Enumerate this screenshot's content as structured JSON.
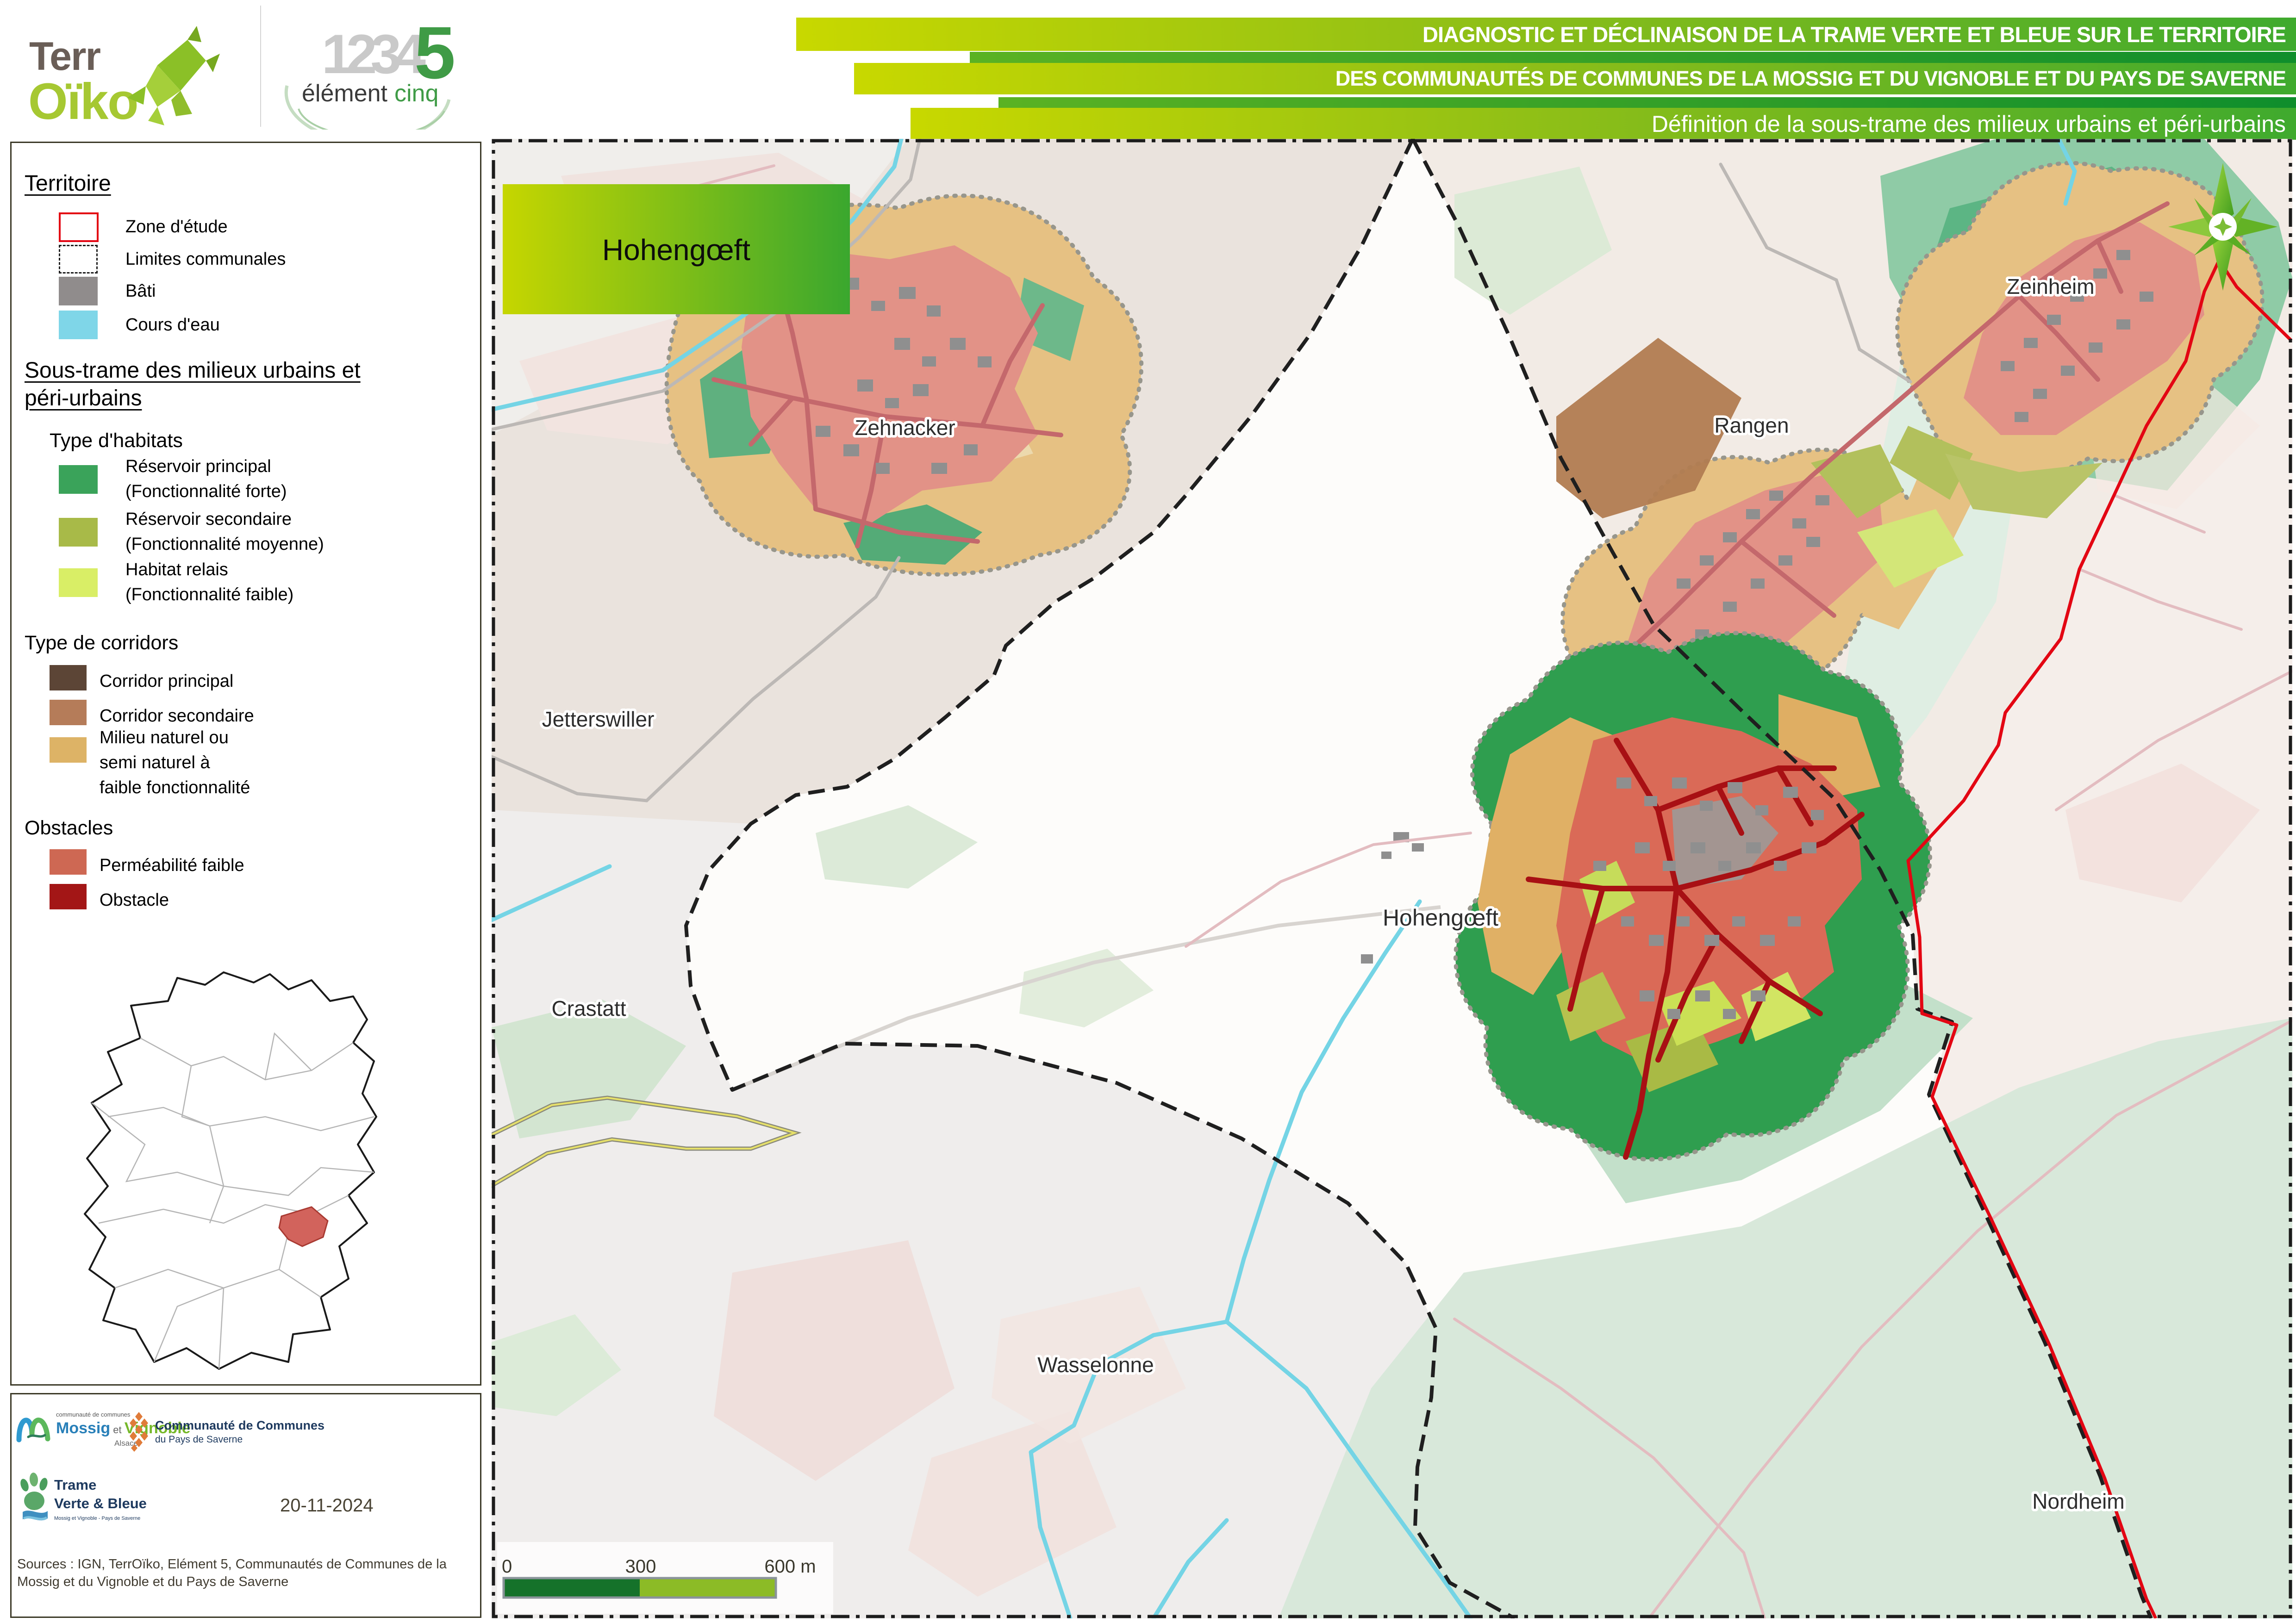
{
  "header": {
    "terroiko": {
      "line1": "Terr",
      "line2": "Oïko"
    },
    "element5": {
      "numbers": "1234",
      "five": "5",
      "word1": "élément",
      "word2": "cinq"
    },
    "banners": [
      {
        "text": "DIAGNOSTIC ET DÉCLINAISON DE LA TRAME VERTE ET BLEUE SUR LE TERRITOIRE"
      },
      {
        "text": "DES COMMUNAUTÉS DE COMMUNES DE LA MOSSIG ET DU VIGNOBLE ET DU PAYS DE SAVERNE"
      },
      {
        "text": "Définition de la sous-trame des milieux urbains et péri-urbains"
      }
    ]
  },
  "legend": {
    "territoire": {
      "title": "Territoire",
      "items": [
        {
          "label": "Zone d'étude",
          "color": "#e30613"
        },
        {
          "label": "Limites communales",
          "color": "#1f1f1f"
        },
        {
          "label": "Bâti",
          "color": "#908c8c"
        },
        {
          "label": "Cours d'eau",
          "color": "#7fd6e8"
        }
      ]
    },
    "soustrame": {
      "title_line1": "Sous-trame des milieux urbains et",
      "title_line2": "péri-urbains",
      "habitats": {
        "title": "Type d'habitats",
        "items": [
          {
            "line1": "Réservoir principal",
            "line2": "(Fonctionnalité forte)",
            "color": "#3aa35a"
          },
          {
            "line1": "Réservoir secondaire",
            "line2": "(Fonctionnalité moyenne)",
            "color": "#a8ba48"
          },
          {
            "line1": "Habitat relais",
            "line2": "(Fonctionnalité faible)",
            "color": "#d9ee66"
          }
        ]
      },
      "corridors": {
        "title": "Type de corridors",
        "items": [
          {
            "label": "Corridor principal",
            "color": "#5c4536"
          },
          {
            "label": "Corridor secondaire",
            "color": "#b57c59"
          },
          {
            "line1": "Milieu naturel ou",
            "line2": "semi naturel à",
            "line3": "faible fonctionnalité",
            "color": "#ddb366"
          }
        ]
      },
      "obstacles": {
        "title": "Obstacles",
        "items": [
          {
            "label": "Perméabilité faible",
            "color": "#ce6853"
          },
          {
            "label": "Obstacle",
            "color": "#a31616"
          }
        ]
      }
    }
  },
  "map": {
    "title_box": "Hohengœft",
    "place_labels": [
      "Zehnacker",
      "Zeinheim",
      "Rangen",
      "Jetterswiller",
      "Crastatt",
      "Hohengœft",
      "Wasselonne",
      "Nordheim"
    ],
    "scale_bar": {
      "start": "0",
      "middle": "300",
      "end": "600 m",
      "color_dark": "#15722a",
      "color_light": "#8cbb26"
    }
  },
  "footer": {
    "mossig": {
      "small": "communauté de communes",
      "name1": "Mossig",
      "et": " et ",
      "name2": "Vignoble",
      "region": "Alsace"
    },
    "saverne": {
      "line1": "Communauté de Communes",
      "line2": "du Pays de Saverne"
    },
    "tvb": {
      "line1": "Trame",
      "line2": "Verte & Bleue",
      "subtitle": "Mossig et Vignoble - Pays de Saverne"
    },
    "date": "20-11-2024",
    "sources": "Sources : IGN, TerrOïko, Elément 5, Communautés de Communes de la Mossig et du Vignoble et du Pays de Saverne"
  }
}
